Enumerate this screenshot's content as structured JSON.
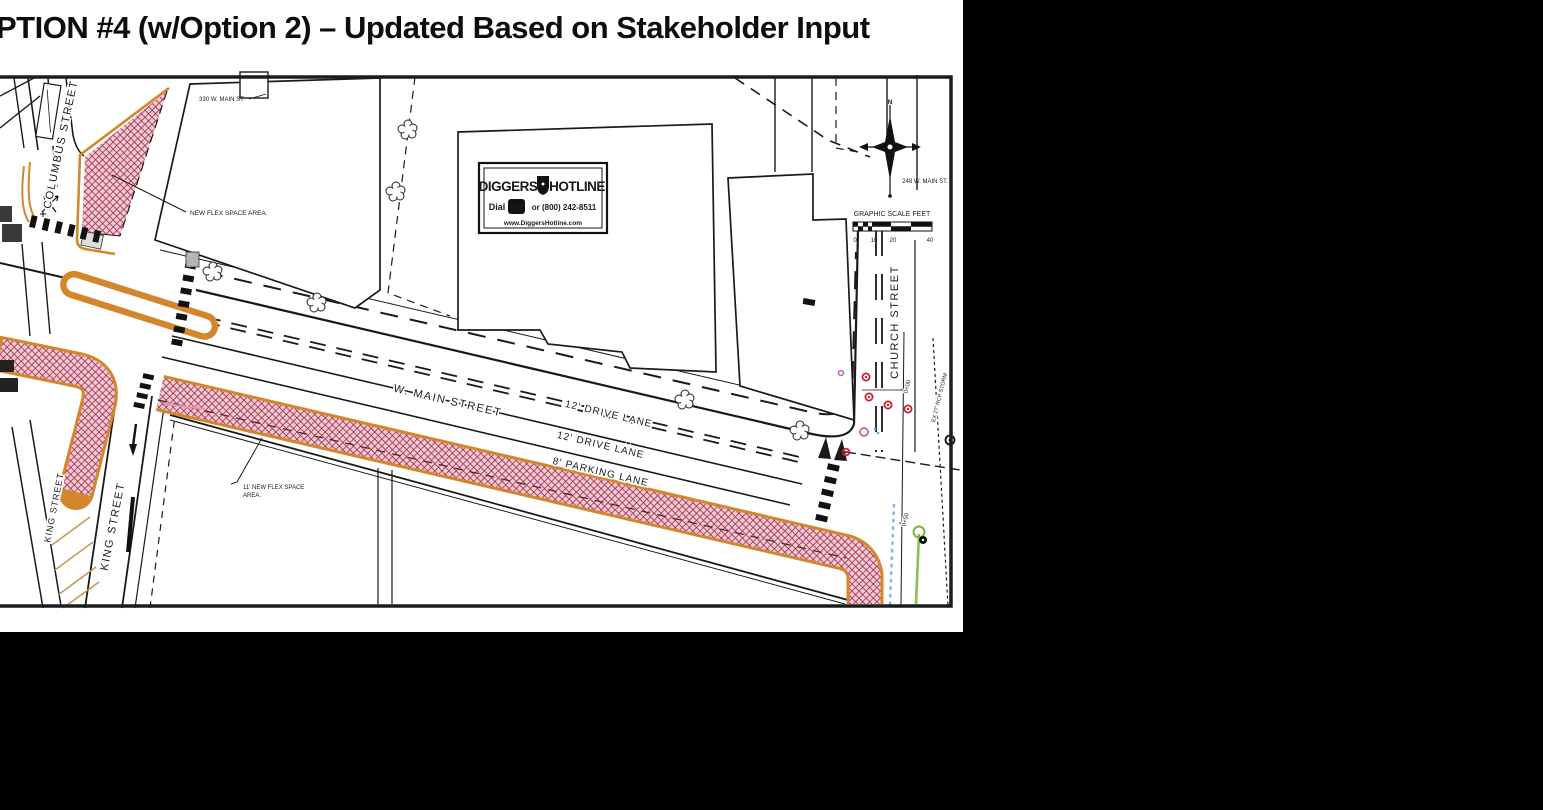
{
  "title": "PTION #4 (w/Option 2) – Updated Based on Stakeholder Input",
  "colors": {
    "flex_hatch_red": "#a83050",
    "flex_hatch_bg": "#f0ccd4",
    "curb_orange": "#d4862c",
    "utility_red": "#cc2030",
    "utility_magenta": "#c060b0",
    "water_blue": "#85b8e8",
    "sewer_green": "#8bc34a",
    "ink": "#1a1a1a"
  },
  "map": {
    "streets": {
      "columbus": "COLUMBUS STREET",
      "w_main": "W. MAIN STREET",
      "king_west": "KING STREET",
      "king": "KING STREET",
      "church": "CHURCH STREET"
    },
    "lanes": {
      "drive1": "12' DRIVE LANE",
      "drive2": "12' DRIVE LANE",
      "parking": "8' PARKING LANE"
    },
    "annotations": {
      "new_flex": "NEW FLEX SPACE AREA.",
      "flex11_l1": "11' NEW FLEX SPACE",
      "flex11_l2": "AREA.",
      "b330": "330 W. MAIN ST.",
      "b248": "248 W. MAIN ST.",
      "storm": "EX 27' RCP STORM",
      "sta_0": "0+00",
      "sta_50": "0+50"
    },
    "compass_n": "N",
    "scale": {
      "title": "GRAPHIC SCALE FEET",
      "t0": "0",
      "t10": "10",
      "t20": "20",
      "t40": "40"
    },
    "hotline": {
      "brand1": "DIGGERS",
      "brand2": "HOTLINE",
      "dial": "Dial",
      "number": "811",
      "phone": "or (800) 242-8511",
      "web": "www.DiggersHotline.com"
    }
  }
}
